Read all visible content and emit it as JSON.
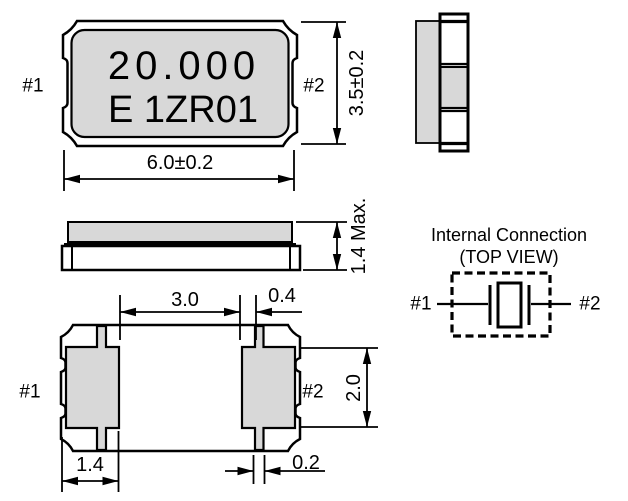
{
  "colors": {
    "body_fill": "#d8d8d8",
    "line": "#000000",
    "background": "#ffffff"
  },
  "top_view": {
    "marking_line1": "20.000",
    "marking_line2": "E 1ZR01",
    "pin1": "#1",
    "pin2": "#2",
    "width_dim": "6.0±0.2",
    "height_dim": "3.5±0.2"
  },
  "side_view": {
    "thickness_dim": "1.4 Max."
  },
  "bottom_view": {
    "pin1": "#1",
    "pin2": "#2",
    "pad_gap_dim": "3.0",
    "castellation_offset_dim": "0.4",
    "pad_height_dim": "2.0",
    "pad_width_dim": "1.4",
    "castellation_width_dim": "0.2"
  },
  "internal_connection": {
    "title": "Internal Connection",
    "subtitle": "(TOP VIEW)",
    "pin1": "#1",
    "pin2": "#2"
  }
}
